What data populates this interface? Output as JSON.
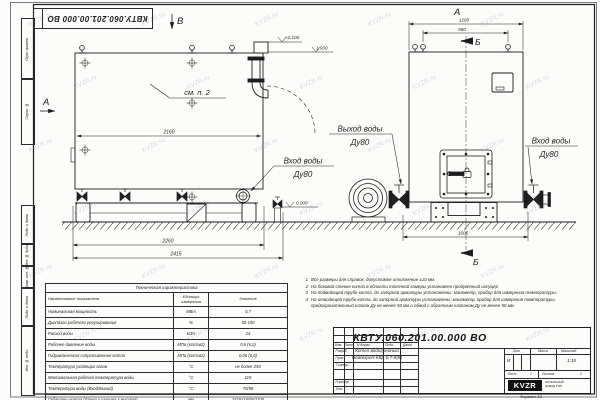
{
  "sheet": {
    "top_stamp_number": "КВТУ.060.201.00.000  ВО",
    "format_label": "Формат А3",
    "watermark": "KVZR.ru",
    "margin_labels": [
      "Перв. примен.",
      "Справ. №",
      "Подп. и дата",
      "Инв. № дубл.",
      "Взам. инв. №",
      "Подп. и дата",
      "Инв. № подл."
    ]
  },
  "views": {
    "side": {
      "view_letter_a": "А",
      "view_letter_b": "В",
      "note_ref": "см. п. 2",
      "dim_inner": "2160",
      "dim_mid": "2260",
      "dim_total": "2415",
      "elev_top": "+2.100",
      "elev_mid": "1.930",
      "elev_zero": "0.000"
    },
    "front": {
      "view_label": "А",
      "section_letter": "Б",
      "dim_top": "1260",
      "dim_lugs": "960",
      "dim_bottom": "1605"
    },
    "labels": {
      "outlet_title": "Выход воды",
      "inlet_title": "Вход воды",
      "dn": "Ду80"
    }
  },
  "table": {
    "title": "Техническая характеристика",
    "headers": [
      "Наименование показателя",
      "Единицы измерения",
      "Значение"
    ],
    "rows": [
      [
        "Номинальная мощность",
        "МВт",
        "0,7"
      ],
      [
        "Диапазон рабочего регулирования",
        "%",
        "50-100"
      ],
      [
        "Расход воды",
        "м3/ч",
        "24"
      ],
      [
        "Рабочее давление воды",
        "МПа (кгс/см2)",
        "0,6 (6,0)"
      ],
      [
        "Гидравлическое сопротивление котла",
        "МПа (кгс/см2)",
        "0,06 (0,6)"
      ],
      [
        "Температура уходящих газов",
        "°С",
        "не более 250"
      ],
      [
        "Максимальная рабочая температура воды",
        "°С",
        "115"
      ],
      [
        "Температура воды (Вход/Выход)",
        "°С",
        "70/95"
      ],
      [
        "Габариты котла (Длина х ширина х высота)",
        "мм",
        "2415х1605х2100"
      ]
    ]
  },
  "notes": {
    "items": [
      {
        "n": "1",
        "text": "Все размеры для справок, допустимое отклонение ±10 мм."
      },
      {
        "n": "2",
        "text": "На боковой стенке котла в области топочной камеры установлен продувочный штуцер"
      },
      {
        "n": "3",
        "text": "На подводящей трубе котла, до запорной арматуры установлены: манометр, прибор для измерения температуры."
      },
      {
        "n": "4",
        "text": "На отводящей трубе котла, до запорной арматуры установлены: манометр, прибор для измерения температуры, предохранительный клапан Ду не менее 50 мм и обвод с обратным клапаном Ду не менее 50 мм."
      }
    ]
  },
  "title_block": {
    "doc_number": "КВТУ.060.201.00.000  ВО",
    "product_line1": "Котел водогрейный",
    "product_line2": "Heatexpert-КВр-0,7-К(К)",
    "cols": [
      "Изм.",
      "Лист",
      "N докум.",
      "Подп.",
      "Дата"
    ],
    "rows": [
      "Разраб.",
      "Пров.",
      "Т.контр.",
      "Н.контр.",
      "Утв."
    ],
    "lit_label": "Лит.",
    "lit_value": "И",
    "mass_label": "Масса",
    "scale_label": "Масштаб",
    "scale_value": "1:15",
    "sheet_label": "Лист",
    "sheet_value": "1",
    "sheets_label": "Листов",
    "sheets_value": "2",
    "logo_text": "KVZR",
    "logo_caption1": "КОТЕЛЬНЫЙ",
    "logo_caption2": "ЗАВОД РЭП"
  }
}
